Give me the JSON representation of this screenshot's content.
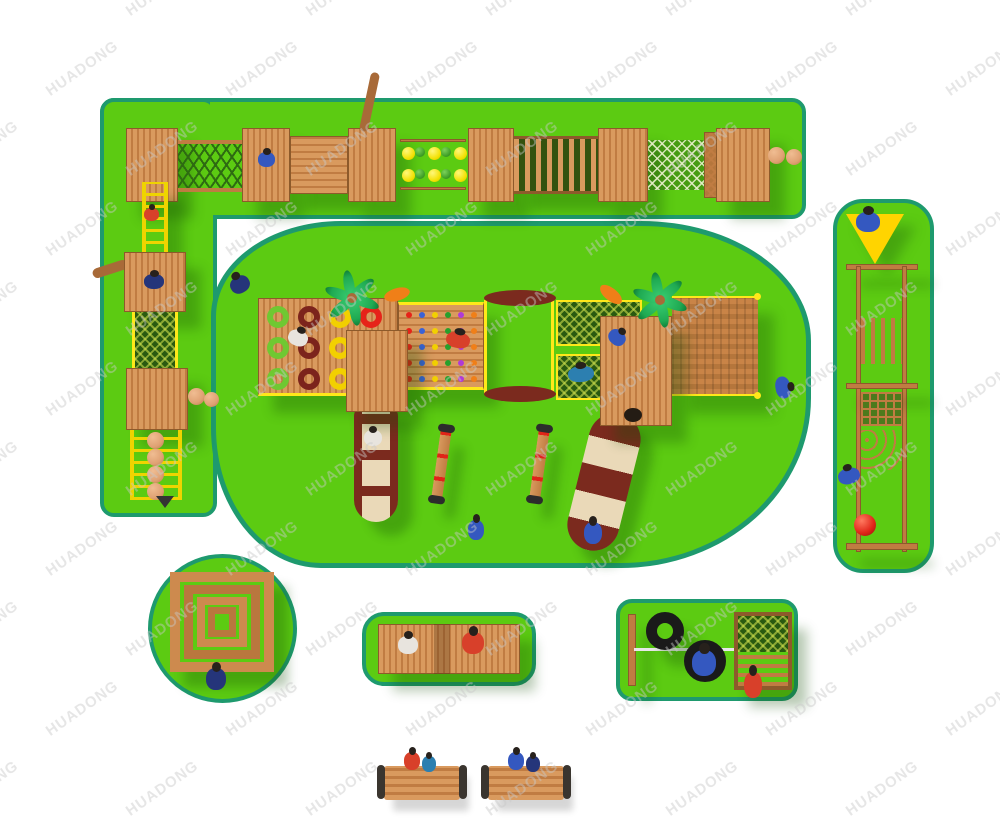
{
  "meta": {
    "width": 1000,
    "height": 833,
    "background": "#ffffff",
    "description": "Top-down 3D render of a wooden adventure playground layout on bright green safety mats"
  },
  "watermark": {
    "text": "HUADONG",
    "color": "#c9c9c9",
    "rotation_deg": -35,
    "rows": 11,
    "cols": 7,
    "x_step": 180,
    "y_step": 80
  },
  "palette": {
    "grass": "#5ccb12",
    "grass_border": "#1e9a6e",
    "wood_light": "#d99a5e",
    "wood_mid": "#c07c42",
    "wood_dark": "#a86a38",
    "wood_edge": "#8d5a2b",
    "net_dark": "#2a5a10",
    "rope_yellow": "#ffe81a",
    "ladder_yellow": "#efd400",
    "slide_maroon": "#7b2a1e",
    "slide_cream": "#ead9b8",
    "disc_yellow": "#f2e000",
    "disc_green": "#3f9e27",
    "palm_green": "#1faa52",
    "leaf_orange": "#f07f18",
    "triangle_yellow": "#ffd400",
    "ball_tan": "#dfa173",
    "ball_red": "#e02418",
    "tire_black": "#1a1a1a",
    "kid_blue": "#3458c0",
    "kid_red": "#d8402a",
    "kid_white": "#e8e4de",
    "kid_navy": "#25357a",
    "kid_teal": "#2c7fb0"
  },
  "rings": {
    "rows": 3,
    "cols": 4,
    "colors": [
      "#6fc832",
      "#7c241c",
      "#f2d000",
      "#e62319"
    ]
  },
  "climb_holds": {
    "rows": 5,
    "cols": 6,
    "colors": [
      "#e62319",
      "#3a62d8",
      "#f2d000",
      "#27a02c",
      "#b03ad8",
      "#f07f18"
    ]
  },
  "discs": {
    "rows": 2,
    "pattern": [
      "yellow",
      "green",
      "yellow",
      "green",
      "yellow"
    ]
  },
  "stepper": {
    "balls": 4
  },
  "palm": {
    "leaves": 6
  }
}
